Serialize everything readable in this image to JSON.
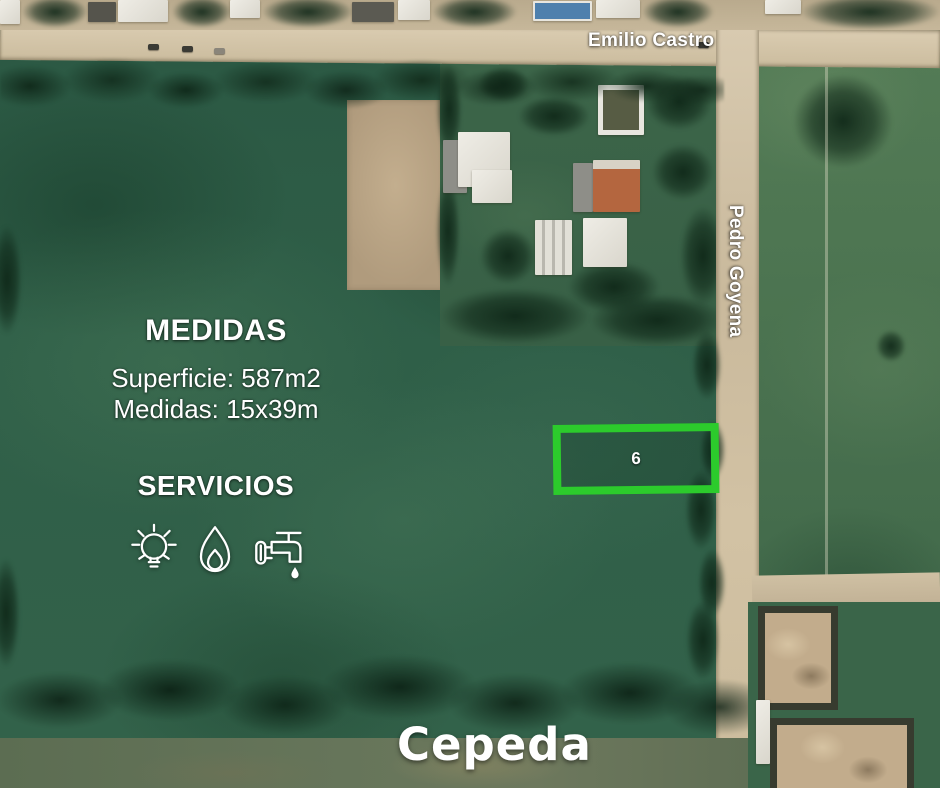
{
  "streets": {
    "horizontal_label": "Emilio Castro",
    "vertical_label": "Pedro Goyena"
  },
  "city_label": "Cepeda",
  "lot": {
    "number": "6",
    "outline_color": "#2ccb2c"
  },
  "info": {
    "medidas_heading": "MEDIDAS",
    "superficie": "Superficie: 587m2",
    "medidas": "Medidas: 15x39m",
    "servicios_heading": "SERVICIOS",
    "services": [
      {
        "name": "electricity-icon"
      },
      {
        "name": "gas-icon"
      },
      {
        "name": "water-icon"
      }
    ]
  },
  "colors": {
    "overlay_text": "#ffffff",
    "lot_outline": "#2ccb2c",
    "road": "#d2c3a6",
    "field_dark": "#2f5d45",
    "field_light": "#4e7854"
  }
}
